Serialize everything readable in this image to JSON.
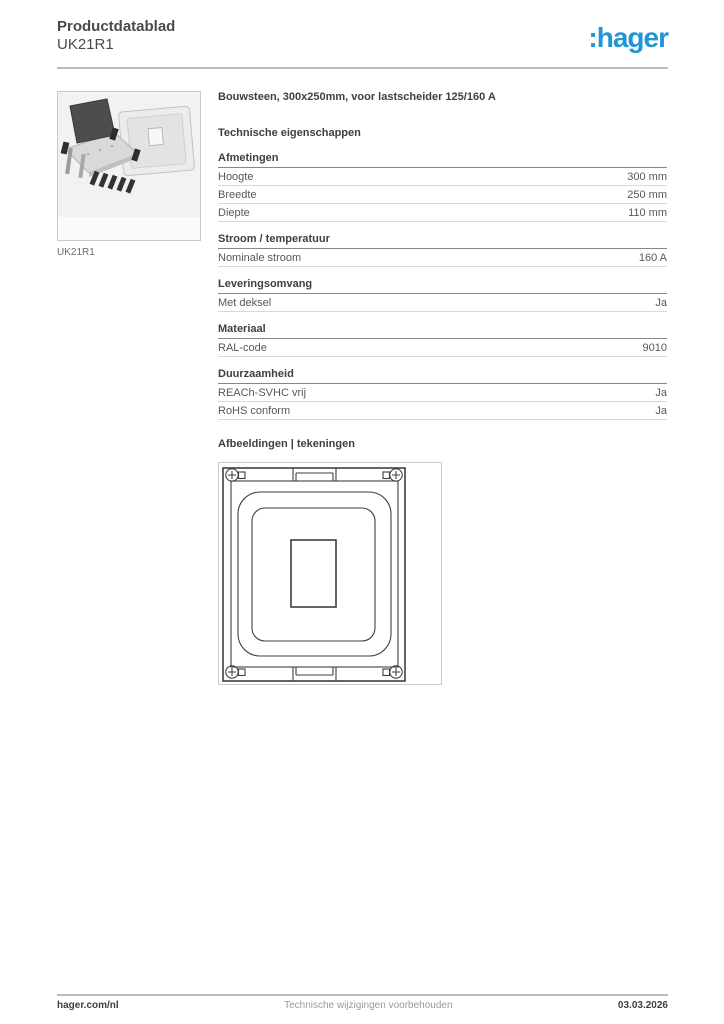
{
  "header": {
    "doc_type": "Productdatablad",
    "product_code": "UK21R1",
    "logo_text": ":hager",
    "accent_color": "#2196d3"
  },
  "product": {
    "title": "Bouwsteen, 300x250mm, voor lastscheider 125/160 A",
    "image_caption": "UK21R1"
  },
  "specs": {
    "section_title": "Technische eigenschappen",
    "groups": [
      {
        "title": "Afmetingen",
        "rows": [
          {
            "label": "Hoogte",
            "value": "300 mm"
          },
          {
            "label": "Breedte",
            "value": "250 mm"
          },
          {
            "label": "Diepte",
            "value": "110 mm"
          }
        ]
      },
      {
        "title": "Stroom / temperatuur",
        "rows": [
          {
            "label": "Nominale stroom",
            "value": "160 A"
          }
        ]
      },
      {
        "title": "Leveringsomvang",
        "rows": [
          {
            "label": "Met deksel",
            "value": "Ja"
          }
        ]
      },
      {
        "title": "Materiaal",
        "rows": [
          {
            "label": "RAL-code",
            "value": "9010"
          }
        ]
      },
      {
        "title": "Duurzaamheid",
        "rows": [
          {
            "label": "REACh-SVHC vrij",
            "value": "Ja"
          },
          {
            "label": "RoHS conform",
            "value": "Ja"
          }
        ]
      }
    ]
  },
  "drawings": {
    "section_title": "Afbeeldingen | tekeningen"
  },
  "footer": {
    "left": "hager.com/nl",
    "center": "Technische wijzigingen voorbehouden",
    "right": "03.03.2026"
  }
}
